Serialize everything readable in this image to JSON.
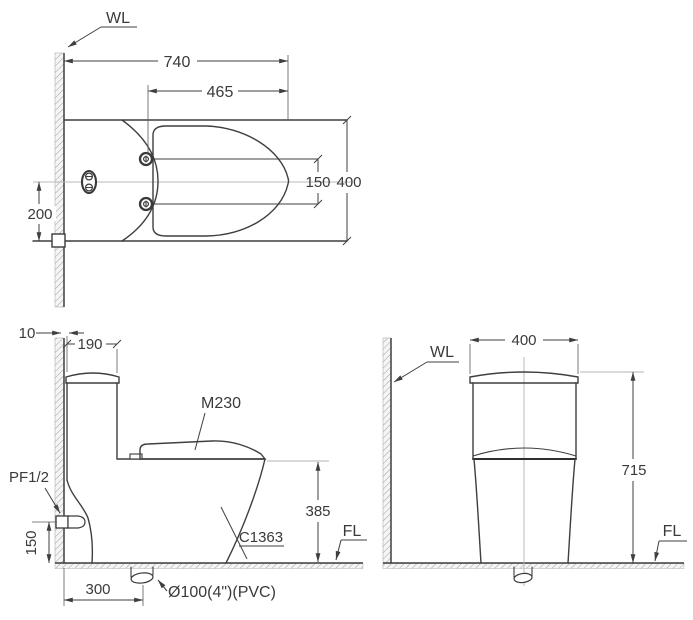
{
  "colors": {
    "line": "#3f3f3f",
    "light_line": "#9a9a9a",
    "centerline": "#b8b8b8",
    "text": "#3a3a3a",
    "background": "#ffffff"
  },
  "top_view": {
    "wall_label": "WL",
    "dim_total_depth": "740",
    "dim_seat_length": "465",
    "dim_hinge_spacing": "150",
    "dim_bowl_width": "400",
    "dim_supply_offset": "200"
  },
  "side_view": {
    "dim_wall_gap": "10",
    "dim_tank_depth": "190",
    "seat_model_label": "M230",
    "supply_label": "PF1/2",
    "dim_supply_height": "150",
    "dim_drain_offset": "300",
    "drain_label": "Ø100(4\")(PVC)",
    "bowl_model_label": "C1363",
    "dim_rim_height": "385",
    "floor_label": "FL"
  },
  "front_view": {
    "wall_label": "WL",
    "dim_tank_width": "400",
    "dim_total_height": "715",
    "floor_label": "FL"
  }
}
